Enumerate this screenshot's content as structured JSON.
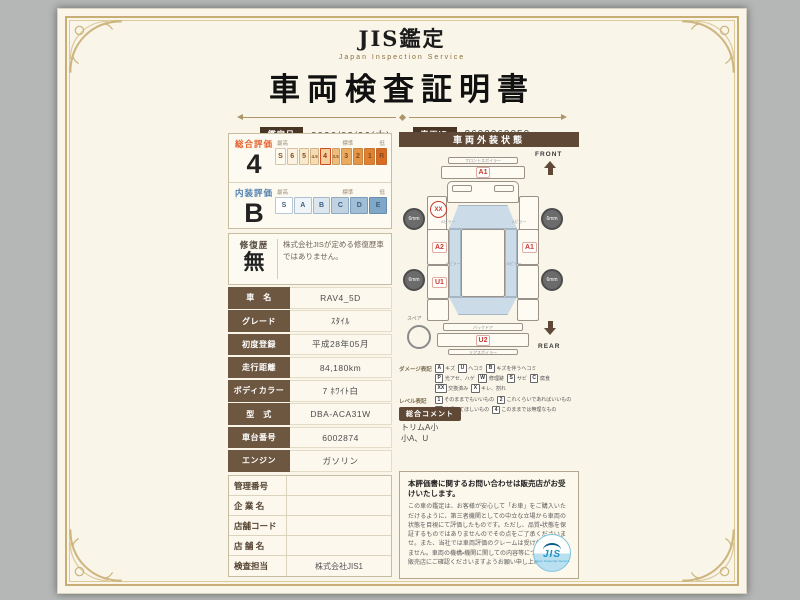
{
  "colors": {
    "brand_brown": "#5f4936",
    "accent_orange": "#e2622d",
    "accent_blue": "#4d7fae",
    "marker_red": "#c6392b",
    "paper": "#f9f5e8",
    "frame_gold": "#c8ad74"
  },
  "header": {
    "brand": "JIS鑑定",
    "brand_sub": "Japan Inspection Service",
    "title": "車両検査証明書",
    "date_label": "鑑定日",
    "date_value": "2026/02/26(木)",
    "id_label": "車両ID",
    "id_value": "2602260050"
  },
  "evaluation": {
    "overall": {
      "label": "総合評価",
      "grade": "4",
      "legend_high": "最高",
      "legend_mid": "標準",
      "legend_low": "低",
      "scale": [
        "S",
        "6",
        "5",
        "4.5",
        "4",
        "3.5",
        "3",
        "2",
        "1",
        "R"
      ]
    },
    "interior": {
      "label": "内装評価",
      "grade": "B",
      "legend_high": "最高",
      "legend_mid": "標準",
      "legend_low": "低",
      "scale": [
        "S",
        "A",
        "B",
        "C",
        "D",
        "E"
      ]
    },
    "repair": {
      "label": "修復歴",
      "value": "無",
      "note": "株式会社JISが定める修復歴車ではありません。"
    }
  },
  "vehicle": {
    "rows": [
      {
        "label": "車　名",
        "value": "RAV4_5D"
      },
      {
        "label": "グレード",
        "value": "ｽﾀｲﾙ"
      },
      {
        "label": "初度登録",
        "value": "平成28年05月"
      },
      {
        "label": "走行距離",
        "value": "84,180km"
      },
      {
        "label": "ボディカラー",
        "value": "7 ﾎﾜｲﾄ白"
      },
      {
        "label": "型　式",
        "value": "DBA-ACA31W"
      },
      {
        "label": "車台番号",
        "value": "6002874"
      },
      {
        "label": "エンジン",
        "value": "ガソリン"
      }
    ]
  },
  "store": {
    "rows": [
      {
        "label": "管理番号",
        "value": ""
      },
      {
        "label": "企 業 名",
        "value": ""
      },
      {
        "label": "店舗コード",
        "value": ""
      },
      {
        "label": "店 舗 名",
        "value": ""
      },
      {
        "label": "検査担当",
        "value": "株式会社JIS1"
      }
    ]
  },
  "exterior": {
    "title": "車両外装状態",
    "front_label": "FRONT",
    "rear_label": "REAR",
    "spare_label": "スペア",
    "tire_front_left": "6mm",
    "tire_front_right": "6mm",
    "tire_rear_left": "6mm",
    "tire_rear_right": "6mm",
    "diagram_labels": {
      "front_spoiler": "フロントスポイラー",
      "a_pillar": "Aピラー",
      "b_pillar": "Bピラー",
      "back_door": "バックドア",
      "rear_spoiler": "リアスポイラー"
    },
    "markers": {
      "front_bumper": "A1",
      "front_left_fender": "XX",
      "left_front_door": "A2",
      "right_front_door": "A1",
      "left_rear_door": "U1",
      "rear_bumper": "U2"
    },
    "damage_legend_label": "ダメージ表記",
    "damage_legend": [
      {
        "code": "A",
        "desc": "キズ"
      },
      {
        "code": "U",
        "desc": "ヘコミ"
      },
      {
        "code": "B",
        "desc": "キズを伴うヘコミ"
      },
      {
        "code": "P",
        "desc": "光アセ、ハゲ"
      },
      {
        "code": "W",
        "desc": "修理跡"
      },
      {
        "code": "S",
        "desc": "サビ"
      },
      {
        "code": "C",
        "desc": "腐食"
      },
      {
        "code": "XX",
        "desc": "交換済み"
      },
      {
        "code": "X",
        "desc": "キレ、割れ"
      }
    ],
    "level_legend_label": "レベル表記",
    "level_legend": [
      {
        "code": "1",
        "desc": "そのままでもいいもの"
      },
      {
        "code": "2",
        "desc": "これくらいであればいいもの"
      },
      {
        "code": "3",
        "desc": "修理してほしいもの"
      },
      {
        "code": "4",
        "desc": "このままでは無理なもの"
      }
    ],
    "comment_label": "総合コメント",
    "comment_lines": [
      "トリムA小",
      "小A、U"
    ]
  },
  "footer": {
    "notice_title": "本評価書に関するお問い合わせは販売店がお受けいたします。",
    "notice_body": "この車の鑑定は、お客様が安心して「お車」をご購入いただけるように、第三者機関としての中立な立場から車両の状態を目視にて評価したものです。ただし、品質・状態を保証するものではありませんのでその点をご了承くださいませ。また、当社では車両評価のクレームは受け付けておりません。車両の機構・機関に関しての内容等については必ず販売店にご確認くださいますようお願い申し上げます。",
    "logo_text": "JIS",
    "logo_sub": "Japan Inspection Service"
  }
}
